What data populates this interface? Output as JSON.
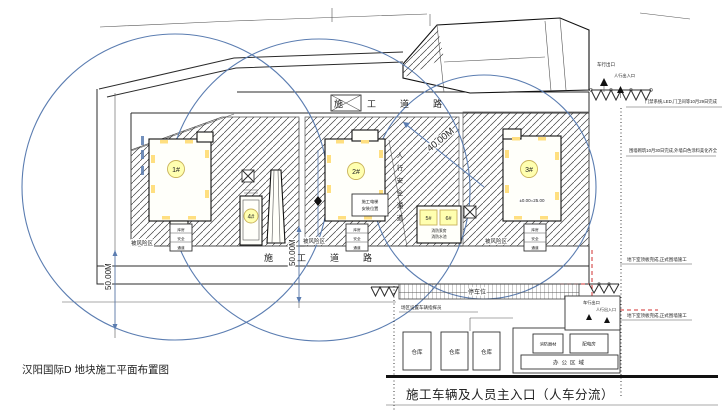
{
  "title": "汉阳国际D 地块施工平面布置图",
  "roads": {
    "top": "施工道路",
    "bottom": "施工道路"
  },
  "dims": {
    "r40": "40.00M",
    "r50_left": "50.00M",
    "r50_mid": "50.00M"
  },
  "buildings": {
    "b1": "1#",
    "b2": "2#",
    "b3": "3#",
    "b4": "4#",
    "b5": "5#",
    "b6": "6#",
    "elevation": "±0.00=25.00",
    "note_56_line1": "消防泵房",
    "note_56_line2": "消防水池",
    "note_b2_line1": "施工电梯",
    "note_b2_line2": "安装位置",
    "walkway_label": "人行安全通道"
  },
  "risk_zone_label": "被风险区",
  "aux_stack": {
    "row1": "库房",
    "row2": "安全",
    "row3": "通道"
  },
  "top_right": {
    "vehicle_exit": "车行出口",
    "pedestrian_entrance": "人行出入口",
    "note_access": "门禁系统,LED,门卫间等10月29日完成",
    "note_wall": "围墙砌筑10月30日完成,外墙白色涂料美化齐全"
  },
  "right_side": {
    "note_basement_1": "地下室顶板完成,正式围墙施工",
    "note_basement_2": "地下室顶板完成,正式围墙施工"
  },
  "bottom": {
    "parking": "停车位",
    "weighbridge_note": "场区设置车辆指挥员",
    "warehouse": "仓库",
    "fire_equipment": "消防器材",
    "power_room": "配电房",
    "office_area": "办公区域",
    "main_entrance": "施工车辆及人员主入口（人车分流）",
    "vehicle_exit": "车行出口",
    "pedestrian_entrance": "人行出入口"
  },
  "colors": {
    "crane_radius_circle": "#5b7db1",
    "red_boundary": "#d03030",
    "building_label": "#ffffb0",
    "hatch_line": "#3a3a3a"
  }
}
